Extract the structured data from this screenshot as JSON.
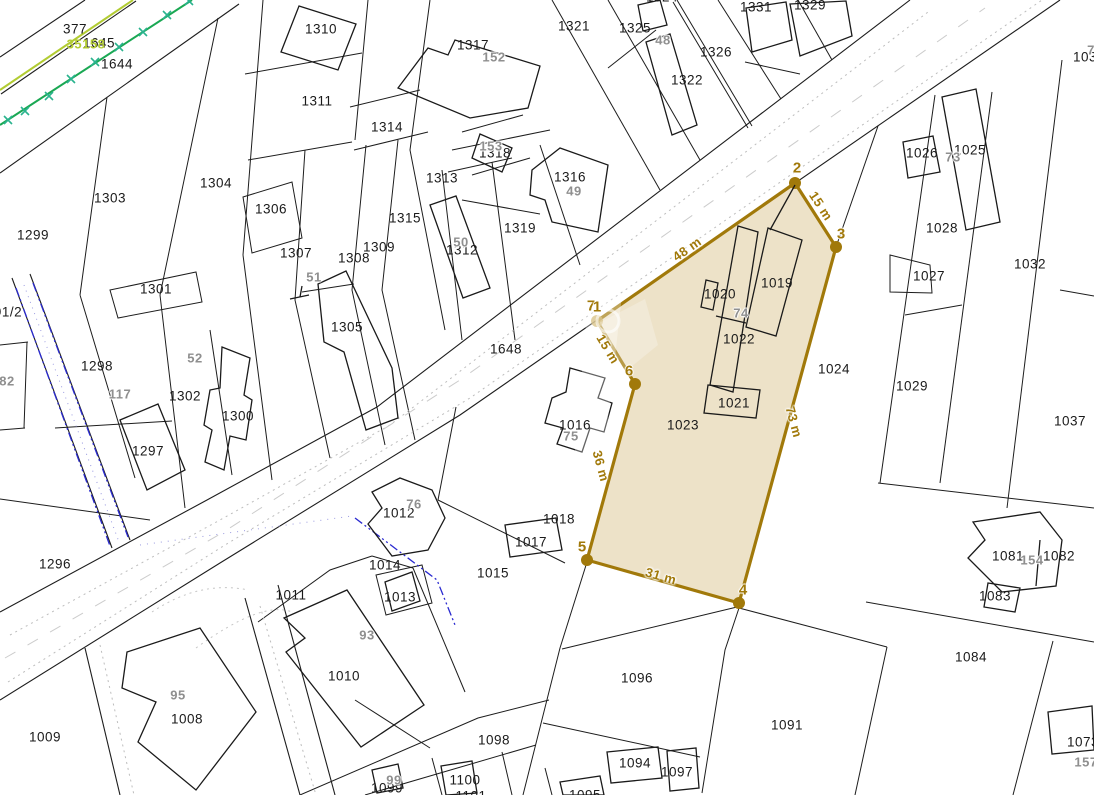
{
  "map": {
    "background": "#ffffff",
    "parcel_line_color": "#1d1d1d",
    "road_dot_color": "#bdbdbd",
    "green_line_color": "#1aa853",
    "green_tick_color": "#2ab38e",
    "yellowgreen_line_color": "#b2cc33",
    "blue_line_color": "#2a2ad0"
  },
  "highlight_parcel": {
    "number": "1023",
    "fill": "#EBDFC3",
    "stroke": "#A1790A",
    "faded_dot_fill": "#C8A955",
    "polygon": [
      [
        597,
        321
      ],
      [
        795,
        183
      ],
      [
        836,
        247
      ],
      [
        739,
        603
      ],
      [
        587,
        560
      ],
      [
        635,
        384
      ]
    ],
    "dots": [
      {
        "x": 795,
        "y": 183,
        "faded": false
      },
      {
        "x": 836,
        "y": 247,
        "faded": false
      },
      {
        "x": 739,
        "y": 603,
        "faded": false
      },
      {
        "x": 587,
        "y": 560,
        "faded": false
      },
      {
        "x": 635,
        "y": 384,
        "faded": false
      },
      {
        "x": 597,
        "y": 321,
        "faded": true
      }
    ],
    "vertex_labels": [
      {
        "text": "7",
        "x": 591,
        "y": 306
      },
      {
        "text": "1",
        "x": 597,
        "y": 307
      },
      {
        "text": "2",
        "x": 797,
        "y": 168
      },
      {
        "text": "3",
        "x": 841,
        "y": 234
      },
      {
        "text": "4",
        "x": 743,
        "y": 590
      },
      {
        "text": "5",
        "x": 582,
        "y": 547
      },
      {
        "text": "6",
        "x": 629,
        "y": 371
      }
    ],
    "measurements": [
      {
        "text": "48 m",
        "x": 687,
        "y": 249,
        "rot": -35
      },
      {
        "text": "15 m",
        "x": 821,
        "y": 206,
        "rot": 57
      },
      {
        "text": "73 m",
        "x": 794,
        "y": 422,
        "rot": 75
      },
      {
        "text": "31 m",
        "x": 661,
        "y": 576,
        "rot": 16
      },
      {
        "text": "36 m",
        "x": 601,
        "y": 466,
        "rot": 75
      },
      {
        "text": "15 m",
        "x": 608,
        "y": 349,
        "rot": 59
      }
    ]
  },
  "labels": {
    "parcels": [
      {
        "text": "377",
        "x": 75,
        "y": 29
      },
      {
        "text": "1645",
        "x": 99,
        "y": 43
      },
      {
        "text": "1644",
        "x": 117,
        "y": 64
      },
      {
        "text": "1310",
        "x": 321,
        "y": 29
      },
      {
        "text": "1311",
        "x": 317,
        "y": 101
      },
      {
        "text": "1314",
        "x": 387,
        "y": 127
      },
      {
        "text": "1317",
        "x": 473,
        "y": 45
      },
      {
        "text": "1321",
        "x": 574,
        "y": 26
      },
      {
        "text": "1325",
        "x": 635,
        "y": 28
      },
      {
        "text": "1324",
        "x": 662,
        "y": -3
      },
      {
        "text": "1322",
        "x": 687,
        "y": 80
      },
      {
        "text": "1326",
        "x": 716,
        "y": 52
      },
      {
        "text": "1331",
        "x": 756,
        "y": 7
      },
      {
        "text": "1329",
        "x": 810,
        "y": 5
      },
      {
        "text": "1304",
        "x": 216,
        "y": 183
      },
      {
        "text": "1303",
        "x": 110,
        "y": 198
      },
      {
        "text": "1299",
        "x": 33,
        "y": 235
      },
      {
        "text": "1306",
        "x": 271,
        "y": 209
      },
      {
        "text": "1307",
        "x": 296,
        "y": 253
      },
      {
        "text": "1308",
        "x": 354,
        "y": 258
      },
      {
        "text": "1309",
        "x": 379,
        "y": 247
      },
      {
        "text": "1313",
        "x": 442,
        "y": 178
      },
      {
        "text": "1318",
        "x": 495,
        "y": 153
      },
      {
        "text": "1316",
        "x": 570,
        "y": 177
      },
      {
        "text": "1319",
        "x": 520,
        "y": 228
      },
      {
        "text": "1315",
        "x": 405,
        "y": 218
      },
      {
        "text": "1312",
        "x": 462,
        "y": 250
      },
      {
        "text": "1305",
        "x": 347,
        "y": 327
      },
      {
        "text": "1301",
        "x": 156,
        "y": 289
      },
      {
        "text": "1298",
        "x": 97,
        "y": 366
      },
      {
        "text": "1302",
        "x": 185,
        "y": 396
      },
      {
        "text": "1300",
        "x": 238,
        "y": 416
      },
      {
        "text": "1297",
        "x": 148,
        "y": 451
      },
      {
        "text": "91/2",
        "x": 8,
        "y": 312
      },
      {
        "text": "1296",
        "x": 55,
        "y": 564
      },
      {
        "text": "1648",
        "x": 506,
        "y": 349
      },
      {
        "text": "1016",
        "x": 575,
        "y": 425
      },
      {
        "text": "1012",
        "x": 399,
        "y": 513
      },
      {
        "text": "1018",
        "x": 559,
        "y": 519
      },
      {
        "text": "1017",
        "x": 531,
        "y": 542
      },
      {
        "text": "1014",
        "x": 385,
        "y": 565
      },
      {
        "text": "1013",
        "x": 400,
        "y": 597
      },
      {
        "text": "1011",
        "x": 291,
        "y": 595
      },
      {
        "text": "1015",
        "x": 493,
        "y": 573
      },
      {
        "text": "1010",
        "x": 344,
        "y": 676
      },
      {
        "text": "1009",
        "x": 45,
        "y": 737
      },
      {
        "text": "1008",
        "x": 187,
        "y": 719
      },
      {
        "text": "1099",
        "x": 387,
        "y": 788
      },
      {
        "text": "1100",
        "x": 465,
        "y": 780
      },
      {
        "text": "1101",
        "x": 471,
        "y": 796
      },
      {
        "text": "1098",
        "x": 494,
        "y": 740
      },
      {
        "text": "1096",
        "x": 637,
        "y": 678
      },
      {
        "text": "1095",
        "x": 585,
        "y": 795
      },
      {
        "text": "1094",
        "x": 635,
        "y": 763
      },
      {
        "text": "1097",
        "x": 677,
        "y": 772
      },
      {
        "text": "1091",
        "x": 787,
        "y": 725
      },
      {
        "text": "1084",
        "x": 971,
        "y": 657
      },
      {
        "text": "1023",
        "x": 683,
        "y": 425
      },
      {
        "text": "1020",
        "x": 720,
        "y": 294
      },
      {
        "text": "1019",
        "x": 777,
        "y": 283
      },
      {
        "text": "1022",
        "x": 739,
        "y": 339
      },
      {
        "text": "1021",
        "x": 734,
        "y": 403
      },
      {
        "text": "1024",
        "x": 834,
        "y": 369
      },
      {
        "text": "1026",
        "x": 922,
        "y": 153
      },
      {
        "text": "1025",
        "x": 970,
        "y": 150
      },
      {
        "text": "1028",
        "x": 942,
        "y": 228
      },
      {
        "text": "1027",
        "x": 929,
        "y": 276
      },
      {
        "text": "1032",
        "x": 1030,
        "y": 264
      },
      {
        "text": "1029",
        "x": 912,
        "y": 386
      },
      {
        "text": "1037",
        "x": 1070,
        "y": 421
      },
      {
        "text": "1081",
        "x": 1008,
        "y": 556
      },
      {
        "text": "1082",
        "x": 1059,
        "y": 556
      },
      {
        "text": "1083",
        "x": 995,
        "y": 596
      },
      {
        "text": "1073",
        "x": 1083,
        "y": 742
      },
      {
        "text": "103",
        "x": 1085,
        "y": 57
      }
    ],
    "buildings": [
      {
        "text": "152",
        "x": 494,
        "y": 57
      },
      {
        "text": "153",
        "x": 491,
        "y": 146
      },
      {
        "text": "49",
        "x": 574,
        "y": 191
      },
      {
        "text": "50",
        "x": 461,
        "y": 242
      },
      {
        "text": "51",
        "x": 314,
        "y": 277
      },
      {
        "text": "48",
        "x": 663,
        "y": 40
      },
      {
        "text": "52",
        "x": 195,
        "y": 358
      },
      {
        "text": "117",
        "x": 120,
        "y": 394
      },
      {
        "text": "73",
        "x": 953,
        "y": 157
      },
      {
        "text": "74",
        "x": 741,
        "y": 313
      },
      {
        "text": "75",
        "x": 571,
        "y": 436
      },
      {
        "text": "76",
        "x": 414,
        "y": 504
      },
      {
        "text": "93",
        "x": 367,
        "y": 635
      },
      {
        "text": "95",
        "x": 178,
        "y": 695
      },
      {
        "text": "99",
        "x": 394,
        "y": 780
      },
      {
        "text": "154",
        "x": 1032,
        "y": 560
      },
      {
        "text": "157",
        "x": 1086,
        "y": 762
      },
      {
        "text": "82",
        "x": 7,
        "y": 381
      },
      {
        "text": "7",
        "x": 1091,
        "y": 50
      }
    ],
    "special": [
      {
        "text": "35158",
        "x": 86,
        "y": 44,
        "color": "#b3cc33"
      }
    ]
  }
}
